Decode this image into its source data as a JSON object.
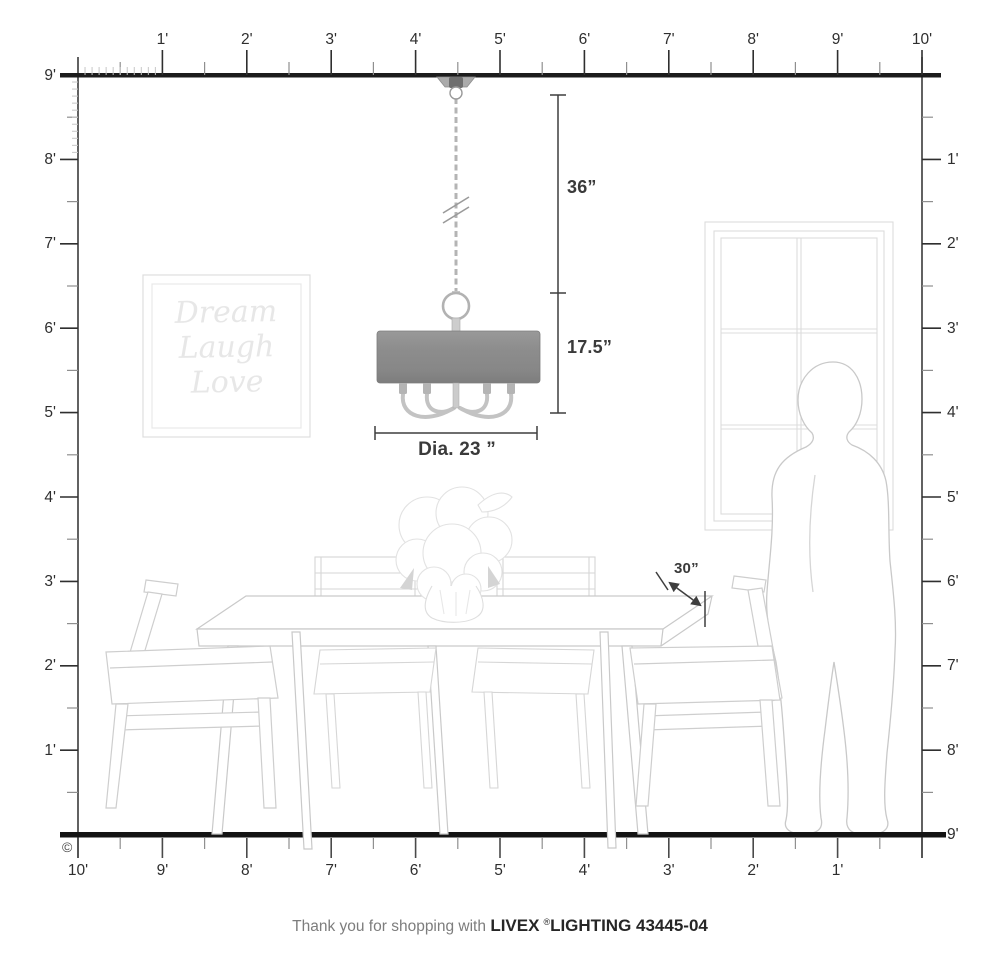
{
  "rulers": {
    "top": [
      "1'",
      "2'",
      "3'",
      "4'",
      "5'",
      "6'",
      "7'",
      "8'",
      "9'",
      "10'"
    ],
    "left": [
      "9'",
      "8'",
      "7'",
      "6'",
      "5'",
      "4'",
      "3'",
      "2'",
      "1'"
    ],
    "right": [
      "1'",
      "2'",
      "3'",
      "4'",
      "5'",
      "6'",
      "7'",
      "8'",
      "9'"
    ],
    "bottom": [
      "10'",
      "9'",
      "8'",
      "7'",
      "6'",
      "5'",
      "4'",
      "3'",
      "2'",
      "1'"
    ]
  },
  "dimensions": {
    "drop": "36”",
    "shade_height": "17.5”",
    "diameter": "Dia. 23 ”",
    "table_clearance": "30”"
  },
  "wall_art": {
    "line1": "Dream",
    "line2": "Laugh",
    "line3": "Love"
  },
  "footer": {
    "prefix": "Thank you for shopping with",
    "brand": "LIVEX",
    "registered": "®",
    "model": "LIGHTING 43445-04"
  },
  "copyright": "©",
  "colors": {
    "shade_gray": "#8d8d8d",
    "ruler_dark": "#2e2e2e",
    "dimension": "#3e3e3e",
    "furniture_line": "#cfcfcf"
  }
}
